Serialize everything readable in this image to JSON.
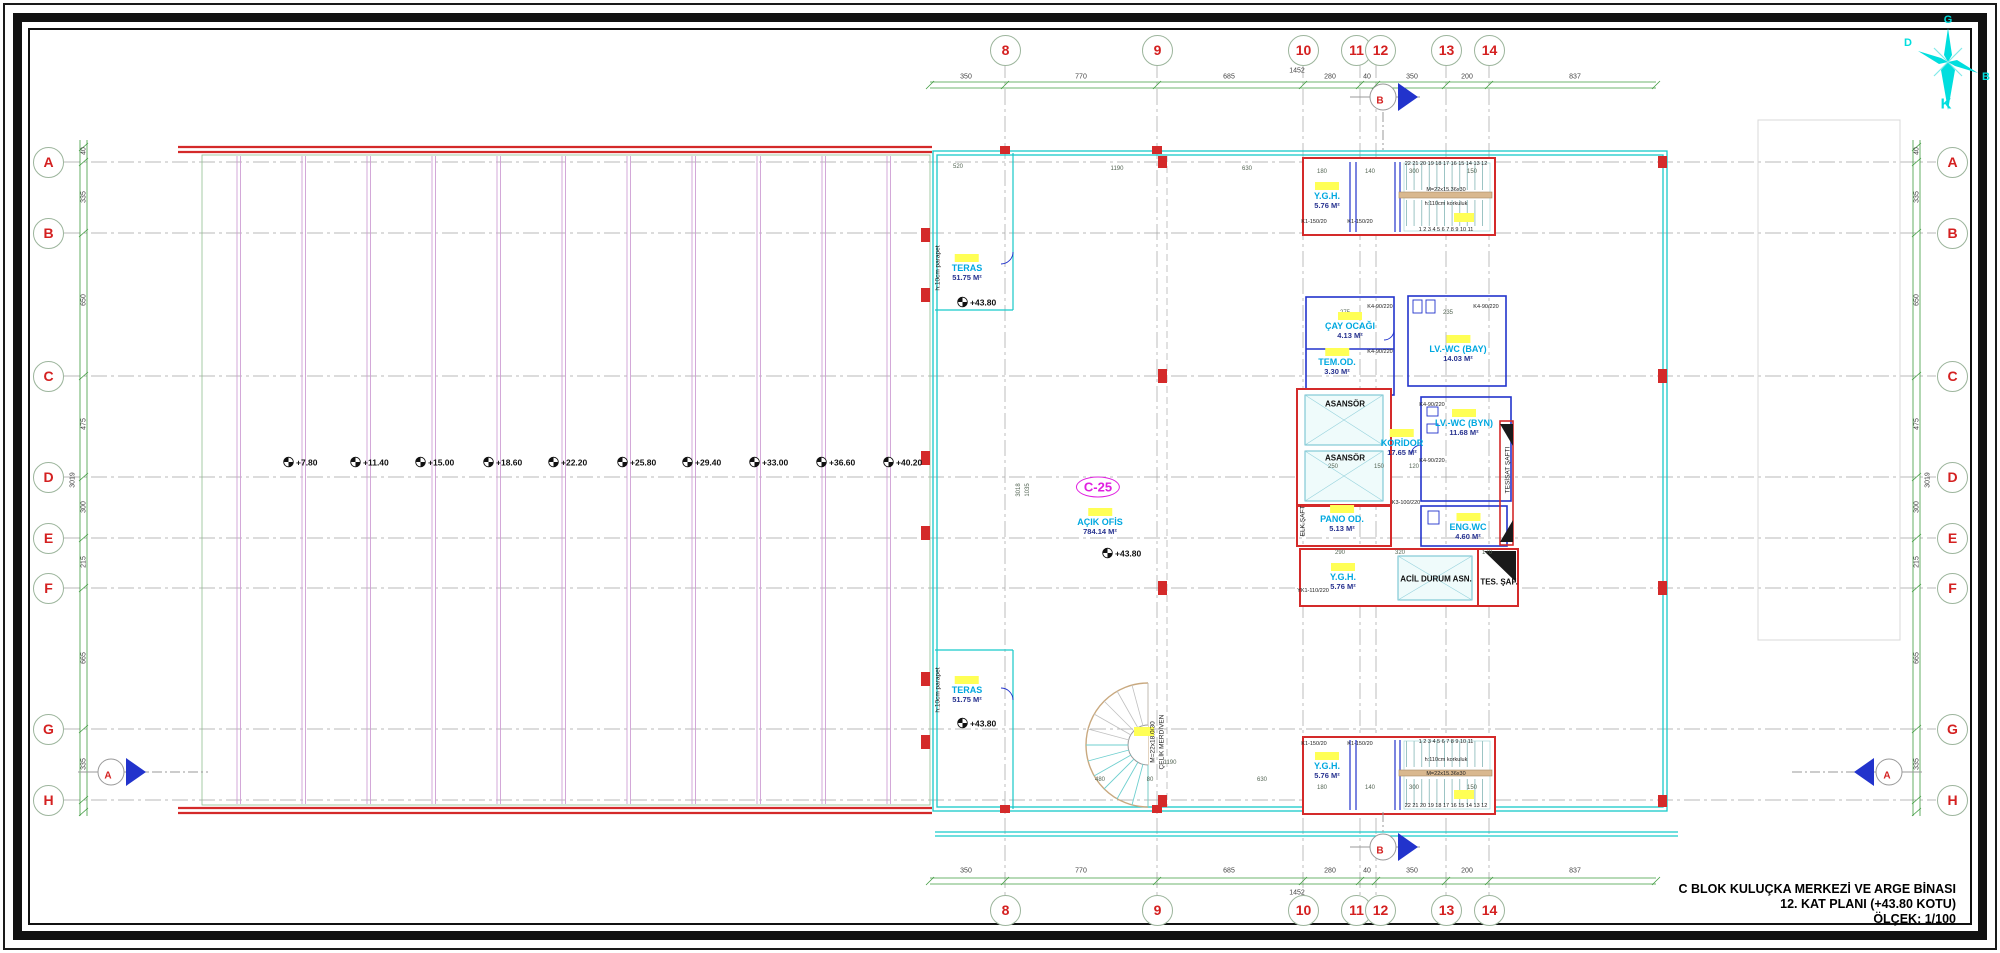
{
  "title_block": {
    "line1": "C BLOK KULUÇKA MERKEZİ VE ARGE BİNASI",
    "line2": "12. KAT PLANI (+43.80 KOTU)",
    "line3": "ÖLÇEK: 1/100"
  },
  "compass": {
    "top": "G",
    "bottom": "K",
    "left": "D",
    "right": "B"
  },
  "c25_badge": "C-25",
  "grid": {
    "columns": [
      {
        "label": "8",
        "x": 1005
      },
      {
        "label": "9",
        "x": 1157
      },
      {
        "label": "10",
        "x": 1303
      },
      {
        "label": "11",
        "x": 1356
      },
      {
        "label": "12",
        "x": 1380
      },
      {
        "label": "13",
        "x": 1446
      },
      {
        "label": "14",
        "x": 1489
      }
    ],
    "rows": [
      {
        "label": "A",
        "y": 162
      },
      {
        "label": "B",
        "y": 233
      },
      {
        "label": "C",
        "y": 376
      },
      {
        "label": "D",
        "y": 477
      },
      {
        "label": "E",
        "y": 538
      },
      {
        "label": "F",
        "y": 588
      },
      {
        "label": "G",
        "y": 729
      },
      {
        "label": "H",
        "y": 800
      }
    ]
  },
  "dimensions": {
    "horizontal": [
      {
        "v": "350",
        "x": 966
      },
      {
        "v": "770",
        "x": 1081
      },
      {
        "v": "685",
        "x": 1229
      },
      {
        "v": "280",
        "x": 1330
      },
      {
        "v": "40",
        "x": 1367
      },
      {
        "v": "350",
        "x": 1412
      },
      {
        "v": "200",
        "x": 1467
      },
      {
        "v": "837",
        "x": 1575
      }
    ],
    "horizontal_total": "1452",
    "vertical": [
      {
        "v": "40",
        "y": 151
      },
      {
        "v": "335",
        "y": 197
      },
      {
        "v": "650",
        "y": 300
      },
      {
        "v": "475",
        "y": 424
      },
      {
        "v": "300",
        "y": 507
      },
      {
        "v": "215",
        "y": 562
      },
      {
        "v": "665",
        "y": 658
      },
      {
        "v": "335",
        "y": 764
      }
    ],
    "vertical_total": "3019",
    "interior": [
      {
        "v": "180",
        "x": 1322,
        "y": 172
      },
      {
        "v": "140",
        "x": 1370,
        "y": 172
      },
      {
        "v": "300",
        "x": 1414,
        "y": 172
      },
      {
        "v": "150",
        "x": 1472,
        "y": 172
      },
      {
        "v": "180",
        "x": 1322,
        "y": 788
      },
      {
        "v": "140",
        "x": 1370,
        "y": 788
      },
      {
        "v": "300",
        "x": 1414,
        "y": 788
      },
      {
        "v": "150",
        "x": 1472,
        "y": 788
      },
      {
        "v": "290",
        "x": 1340,
        "y": 553
      },
      {
        "v": "320",
        "x": 1400,
        "y": 553
      },
      {
        "v": "170",
        "x": 1487,
        "y": 553
      },
      {
        "v": "250",
        "x": 1333,
        "y": 467
      },
      {
        "v": "150",
        "x": 1379,
        "y": 467
      },
      {
        "v": "120",
        "x": 1414,
        "y": 467
      },
      {
        "v": "520",
        "x": 958,
        "y": 167
      },
      {
        "v": "1190",
        "x": 1117,
        "y": 169
      },
      {
        "v": "630",
        "x": 1247,
        "y": 169
      },
      {
        "v": "480",
        "x": 1100,
        "y": 780
      },
      {
        "v": "80",
        "x": 1150,
        "y": 780
      },
      {
        "v": "630",
        "x": 1262,
        "y": 780
      },
      {
        "v": "1190",
        "x": 1170,
        "y": 763
      },
      {
        "v": "275",
        "x": 1345,
        "y": 313
      },
      {
        "v": "235",
        "x": 1448,
        "y": 313
      }
    ],
    "interior_vertical": [
      {
        "v": "3018",
        "x": 1019,
        "y": 490
      },
      {
        "v": "1035",
        "x": 1028,
        "y": 490
      }
    ]
  },
  "levels": {
    "terrace_row": [
      {
        "v": "+7.80",
        "x": 283
      },
      {
        "v": "+11.40",
        "x": 350
      },
      {
        "v": "+15.00",
        "x": 415
      },
      {
        "v": "+18.60",
        "x": 483
      },
      {
        "v": "+22.20",
        "x": 548
      },
      {
        "v": "+25.80",
        "x": 617
      },
      {
        "v": "+29.40",
        "x": 682
      },
      {
        "v": "+33.00",
        "x": 749
      },
      {
        "v": "+36.60",
        "x": 816
      },
      {
        "v": "+40.20",
        "x": 883
      }
    ],
    "spots": [
      {
        "v": "+43.80",
        "x": 957,
        "y": 302
      },
      {
        "v": "+43.80",
        "x": 957,
        "y": 723
      },
      {
        "v": "+43.80",
        "x": 1102,
        "y": 553
      }
    ]
  },
  "rooms": [
    {
      "name": "TERAS",
      "area": "51.75 M²",
      "x": 967,
      "y": 254
    },
    {
      "name": "Y.G.H.",
      "area": "5.76 M²",
      "x": 1327,
      "y": 182
    },
    {
      "name": "ÇAY OCAĞI",
      "area": "4.13 M²",
      "x": 1350,
      "y": 312
    },
    {
      "name": "TEM.OD.",
      "area": "3.30 M²",
      "x": 1337,
      "y": 348
    },
    {
      "name": "LV.-WC (BAY)",
      "area": "14.03 M²",
      "x": 1458,
      "y": 335
    },
    {
      "name": "LV.-WC (BYN)",
      "area": "11.68 M²",
      "x": 1464,
      "y": 409
    },
    {
      "name": "KORİDOR",
      "area": "17.65 M²",
      "x": 1402,
      "y": 429
    },
    {
      "name": "AÇIK OFİS",
      "area": "784.14 M²",
      "x": 1100,
      "y": 508
    },
    {
      "name": "PANO OD.",
      "area": "5.13 M²",
      "x": 1342,
      "y": 505
    },
    {
      "name": "ENG.WC",
      "area": "4.60 M²",
      "x": 1468,
      "y": 513
    },
    {
      "name": "Y.G.H.",
      "area": "5.76 M²",
      "x": 1343,
      "y": 563
    },
    {
      "name": "TERAS",
      "area": "51.75 M²",
      "x": 967,
      "y": 676
    },
    {
      "name": "Y.G.H.",
      "area": "5.76 M²",
      "x": 1327,
      "y": 752
    }
  ],
  "labels_black": [
    {
      "t": "ASANSÖR",
      "x": 1345,
      "y": 404
    },
    {
      "t": "ASANSÖR",
      "x": 1345,
      "y": 458
    },
    {
      "t": "ACİL DURUM ASN.",
      "x": 1436,
      "y": 579
    },
    {
      "t": "TES. ŞAF.",
      "x": 1499,
      "y": 582
    }
  ],
  "labels_vertical": [
    {
      "t": "ELK.ŞAFT",
      "x": 1303,
      "y": 521
    },
    {
      "t": "TESİSAT ŞAFTI",
      "x": 1508,
      "y": 470
    },
    {
      "t": "h:10cm parapet",
      "x": 938,
      "y": 268
    },
    {
      "t": "h:10cm parapet",
      "x": 938,
      "y": 690
    },
    {
      "t": "M=22x18.0/30",
      "x": 1153,
      "y": 742
    },
    {
      "t": "ÇELİK MERDİVEN",
      "x": 1162,
      "y": 742
    }
  ],
  "small_labels": [
    {
      "t": "22 21 20 19 18 17 16 15 14 13 12",
      "x": 1446,
      "y": 164
    },
    {
      "t": "1 2 3 4 5 6 7 8 9 10 11",
      "x": 1446,
      "y": 230
    },
    {
      "t": "M=22x15.36x30",
      "x": 1446,
      "y": 190
    },
    {
      "t": "h:110cm korkuluk",
      "x": 1446,
      "y": 204
    },
    {
      "t": "1 2 3 4 5 6 7 8 9 10 11",
      "x": 1446,
      "y": 742
    },
    {
      "t": "h:110cm korkuluk",
      "x": 1446,
      "y": 760
    },
    {
      "t": "M=22x15.36x30",
      "x": 1446,
      "y": 774
    },
    {
      "t": "22 21 20 19 18 17 16 15 14 13 12",
      "x": 1446,
      "y": 806
    },
    {
      "t": "K1-150/20",
      "x": 1314,
      "y": 222
    },
    {
      "t": "K1-150/20",
      "x": 1360,
      "y": 222
    },
    {
      "t": "K1-150/20",
      "x": 1314,
      "y": 744
    },
    {
      "t": "K1-150/20",
      "x": 1360,
      "y": 744
    },
    {
      "t": "K4-90/220",
      "x": 1380,
      "y": 307
    },
    {
      "t": "K4-90/220",
      "x": 1380,
      "y": 352
    },
    {
      "t": "K4-90/220",
      "x": 1486,
      "y": 307
    },
    {
      "t": "K4-90/220",
      "x": 1432,
      "y": 405
    },
    {
      "t": "K4-90/220",
      "x": 1432,
      "y": 461
    },
    {
      "t": "K3-100/220",
      "x": 1406,
      "y": 503
    },
    {
      "t": "YK1-110/220",
      "x": 1313,
      "y": 591
    }
  ],
  "sections": [
    {
      "label": "B"
    },
    {
      "label": "B"
    },
    {
      "label": "A"
    },
    {
      "label": "A"
    }
  ],
  "colors": {
    "wall_red": "#d42a2a",
    "wall_cyan": "#17c9c9",
    "wall_blue": "#2233cc",
    "terrace_magenta": "#cf9fd4",
    "dimension_green": "#3f9b3f",
    "grid_label_red": "#d42020",
    "room_label_cyan": "#00a8e0",
    "area_navy": "#26318f",
    "highlight_yellow": "#ffff55",
    "compass_cyan": "#00dede",
    "c25_magenta": "#e020e0"
  }
}
